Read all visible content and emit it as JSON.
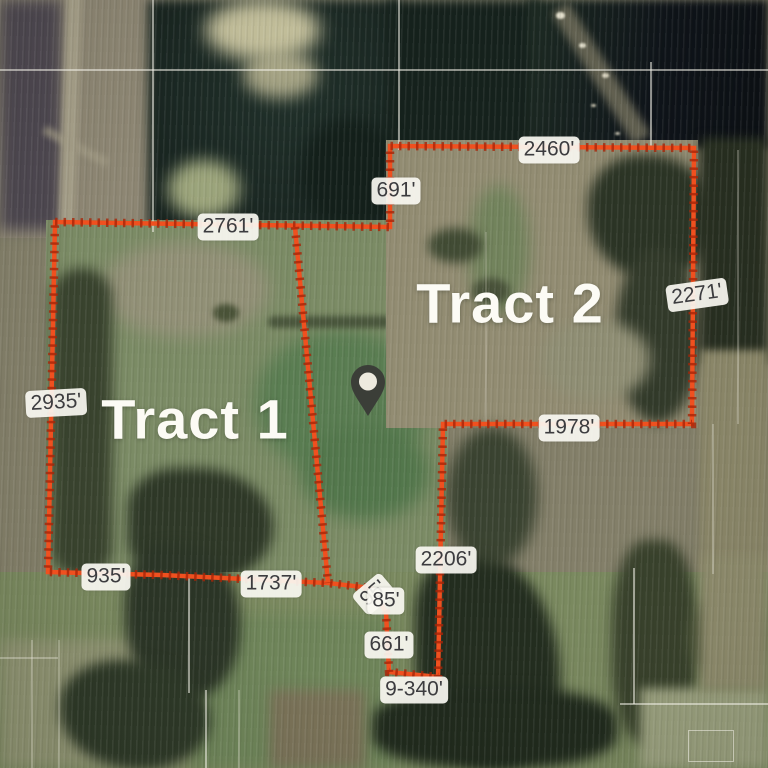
{
  "map": {
    "tract_labels": [
      {
        "text": "Tract 1"
      },
      {
        "text": "Tract 2"
      }
    ],
    "segments": {
      "west": "2935'",
      "north_west": "2761'",
      "north_jog": "691'",
      "north_east": "2460'",
      "east": "2271'",
      "tract2_south": "1978'",
      "south_east": "2206'",
      "south_1": "935'",
      "south_2": "1737'",
      "south_jog_rotated": "95'",
      "south_jog": "85'",
      "south_drop": "661'",
      "south_bottom": "9-340'"
    },
    "colors": {
      "boundary": "#f0501f",
      "boundary_tick": "#a82408",
      "label_background": "#faf8f2",
      "label_text": "#3c3c3f",
      "tract_label_text": "#fcfbf5"
    },
    "icons": {
      "pin": "location-pin"
    }
  }
}
